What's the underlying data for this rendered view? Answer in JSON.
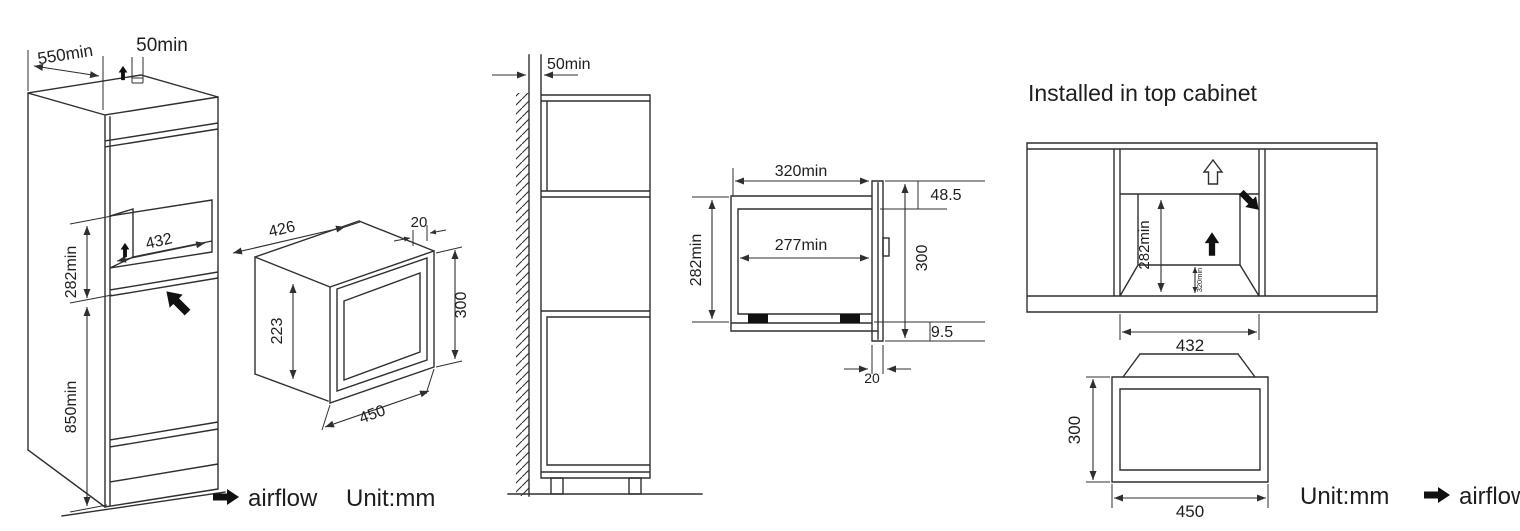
{
  "colors": {
    "line": "#2f2f2f",
    "text": "#1e1e1e",
    "background": "#ffffff"
  },
  "tall_cabinet_iso": {
    "depth": "550min",
    "top_gap": "50min",
    "opening_width": "432",
    "opening_height": "282min",
    "floor_height": "850min"
  },
  "microwave_iso": {
    "body_depth": "426",
    "frame_overhang": "20",
    "body_height": "223",
    "front_height": "300",
    "front_width": "450"
  },
  "wall_side_view": {
    "wall_gap": "50min"
  },
  "section_view": {
    "niche_depth": "320min",
    "body_depth": "277min",
    "niche_height": "282min",
    "top_clearance": "48.5",
    "front_height": "300",
    "bottom_overlap": "9.5",
    "frame_thickness": "20"
  },
  "top_cabinet_front": {
    "title": "Installed in top cabinet",
    "opening_height": "282min",
    "vent_clearance": "320min",
    "opening_width": "432"
  },
  "microwave_front": {
    "front_height": "300",
    "front_width": "450"
  },
  "footer_left": {
    "airflow": "airflow",
    "unit": "Unit:mm"
  },
  "footer_right": {
    "unit": "Unit:mm",
    "airflow": "airflow"
  }
}
